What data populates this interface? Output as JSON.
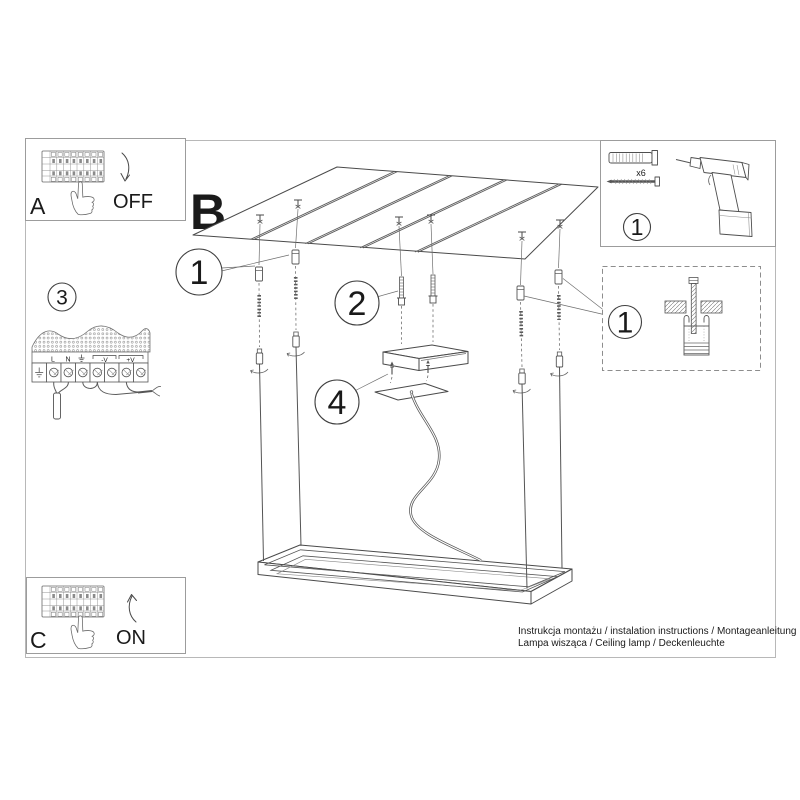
{
  "sheet": {
    "panel_a": {
      "letter": "A",
      "state_label": "OFF"
    },
    "panel_c": {
      "letter": "C",
      "state_label": "ON"
    },
    "main_step_letter": "B",
    "wiring_step": {
      "number": "3",
      "terminal_l": "L",
      "terminal_n": "N",
      "terminal_minus": "-V",
      "terminal_plus": "+V"
    },
    "callouts": {
      "anchors": "1",
      "screws": "2",
      "canopy": "4"
    },
    "parts_box": {
      "number": "1",
      "dowel_quantity": "x6"
    },
    "detail_box": {
      "number": "1"
    },
    "footer": {
      "line1": "Instrukcja montażu / instalation instructions / Montageanleitung",
      "line2": "Lampa wisząca / Ceiling lamp / Deckenleuchte"
    },
    "colors": {
      "line": "#4a4a4a",
      "page_frame": "#b8b8b8",
      "text": "#1a1a1a"
    }
  }
}
